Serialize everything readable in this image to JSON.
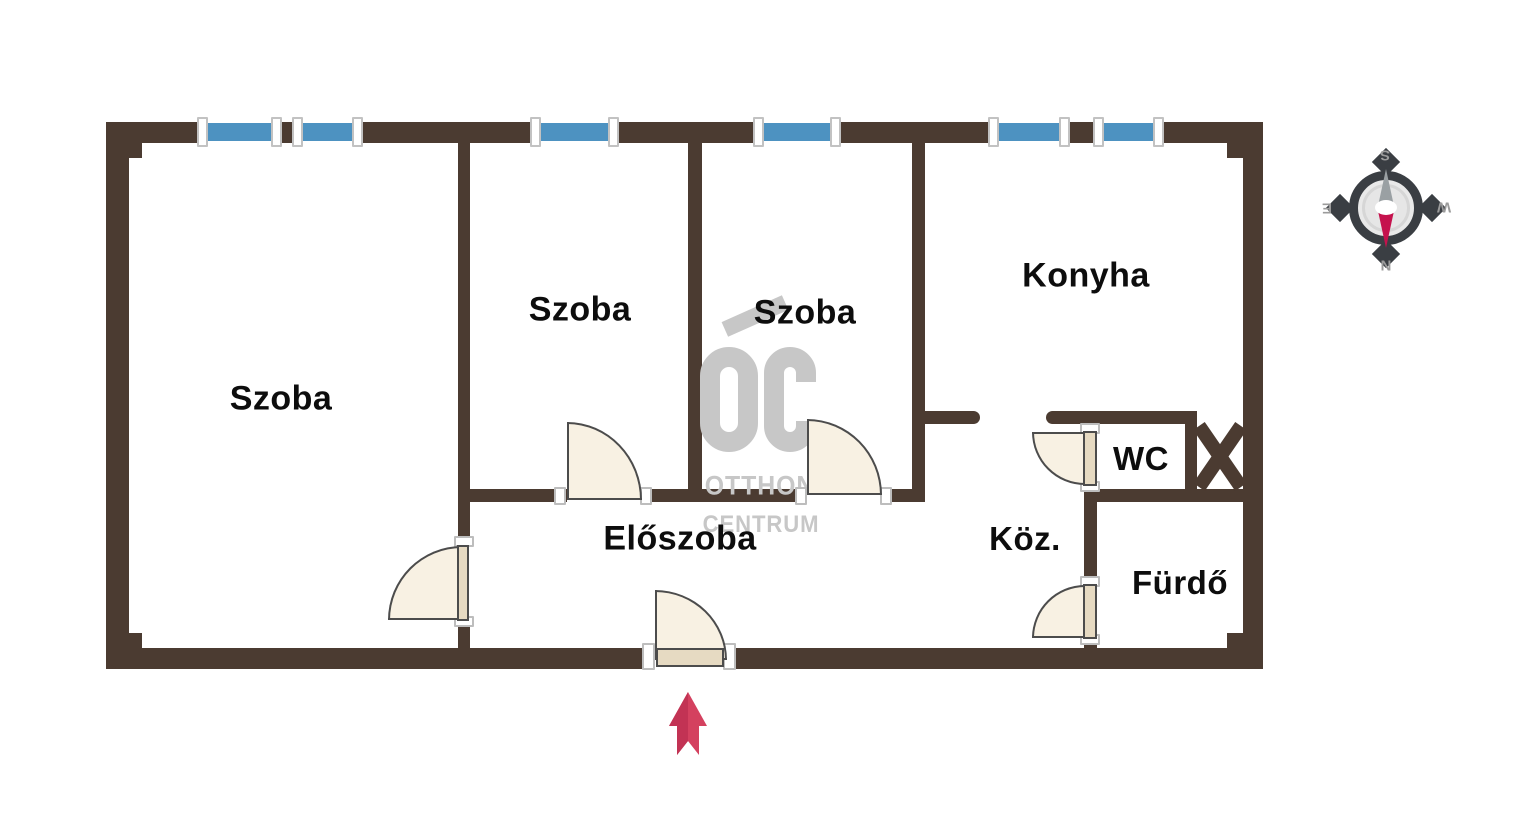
{
  "plan": {
    "rooms": [
      {
        "id": "szoba-1",
        "label": "Szoba"
      },
      {
        "id": "szoba-2",
        "label": "Szoba"
      },
      {
        "id": "szoba-3",
        "label": "Szoba"
      },
      {
        "id": "konyha",
        "label": "Konyha"
      },
      {
        "id": "eloszoba",
        "label": "Előszoba"
      },
      {
        "id": "koz",
        "label": "Köz."
      },
      {
        "id": "wc",
        "label": "WC"
      },
      {
        "id": "furdo",
        "label": "Fürdő"
      }
    ]
  },
  "watermark": {
    "initials": "OC",
    "line1": "OTTHON",
    "line2": "CENTRUM"
  },
  "compass": {
    "top": "S",
    "bottom": "N",
    "left": "E",
    "right": "W"
  },
  "colors": {
    "wall": "#4b3b31",
    "window": "#4d92c1",
    "door_fill": "#f8f1e3",
    "door_leaf": "#e6dac2",
    "entrance_arrow": "#d4415f",
    "compass_needle_red": "#c5124d",
    "compass_ring": "#3a3e43",
    "watermark_gray": "#c7c7c7",
    "label_text": "#0d0d0d"
  }
}
